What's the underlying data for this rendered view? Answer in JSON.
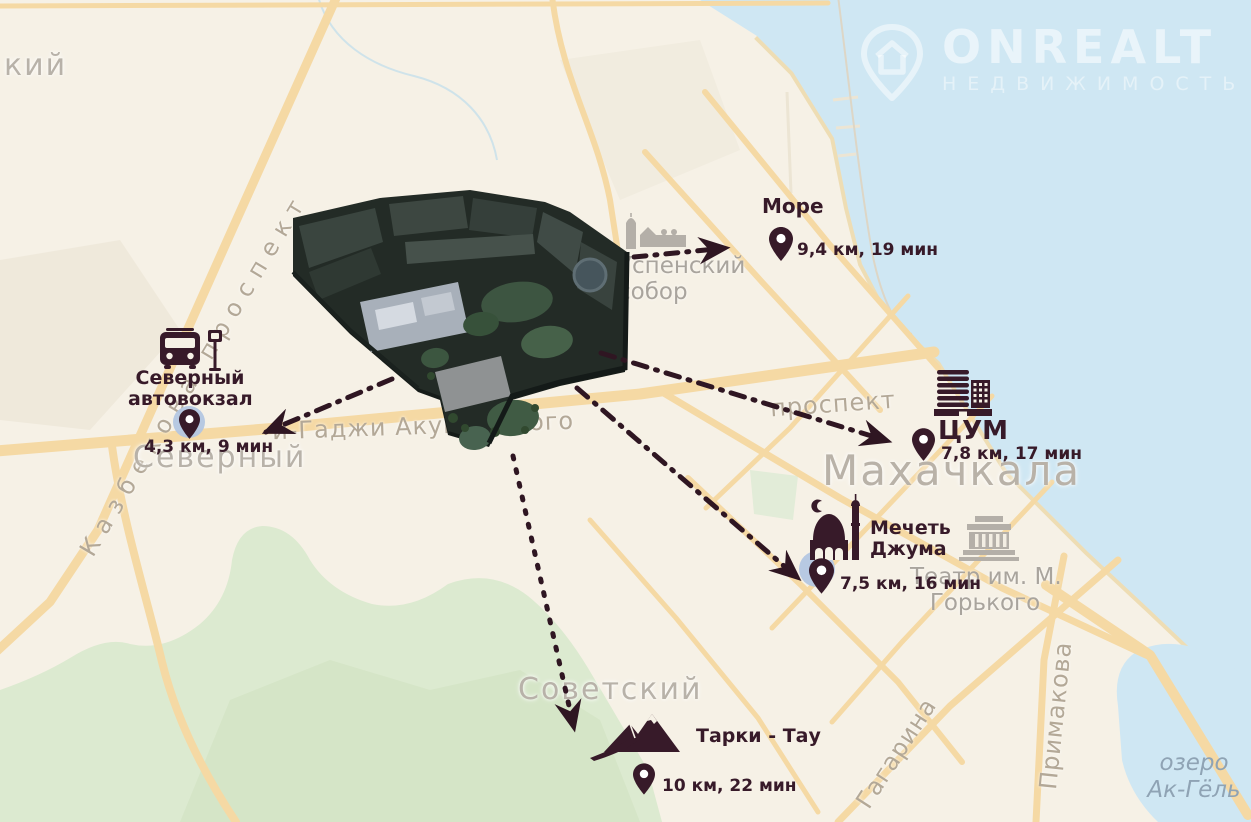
{
  "logo": {
    "brand": "ONREALT",
    "tagline": "НЕДВИЖИМОСТЬ"
  },
  "landmarks": {
    "sea": {
      "label": "Море",
      "distance": "9,4 км, 19 мин"
    },
    "bus": {
      "label_line1": "Северный",
      "label_line2": "автовокзал",
      "distance": "4,3 км, 9 мин"
    },
    "tsum": {
      "label": "ЦУМ",
      "distance": "7,8 км, 17 мин"
    },
    "mosque": {
      "label_line1": "Мечеть",
      "label_line2": "Джума",
      "distance": "7,5 км, 16 мин"
    },
    "tarki": {
      "label": "Тарки - Тау",
      "distance": "10 км, 22 мин"
    }
  },
  "map_labels": {
    "city": "Махачкала",
    "district_top_left_partial": "кий",
    "district_severny": "Северный",
    "district_sovetsky": "Советский",
    "cathedral_line1": "Успенский",
    "cathedral_line2": "собор",
    "theater_line1": "Театр им. М.",
    "theater_line2": "Горького",
    "street_kazbekova": "Казбекова проспект",
    "street_akushinskogo": "и-Гаджи Акушинского",
    "street_prospekt": "проспект",
    "street_gagarina": "Гагарина",
    "street_primakova": "Примакова",
    "lake_line1": "озеро",
    "lake_line2": "Ак-Гёль"
  },
  "colors": {
    "accent_dark": "#371a29",
    "water": "#cfe7f3",
    "road": "#f5d9a4",
    "green": "#dcead0",
    "map_label_gray": "#b8b2a9"
  }
}
